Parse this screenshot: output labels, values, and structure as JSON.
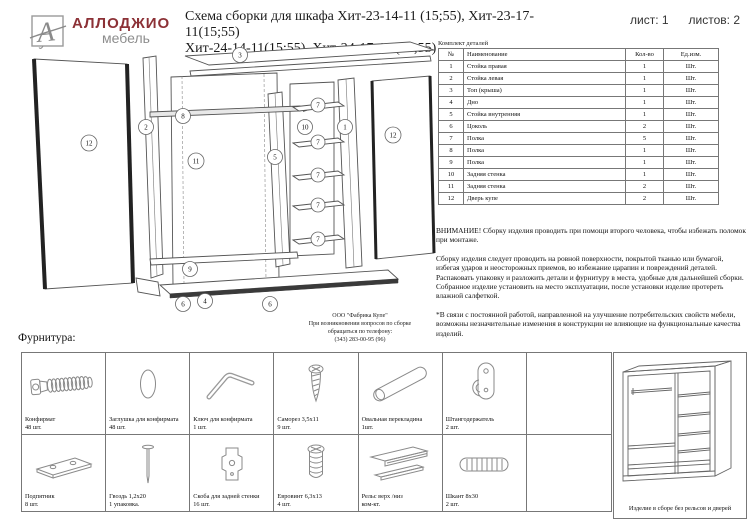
{
  "header": {
    "brand": "АЛЛОДЖИО",
    "brand_sub": "мебель",
    "title_line1": "Схема сборки для шкафа Хит-23-14-11 (15;55), Хит-23-17-11(15;55)",
    "title_line2": "Хит-24-14-11(15;55), Хит-24-17-11 (15;55)",
    "sheet": "лист: 1",
    "sheets_total": "листов: 2"
  },
  "parts_table": {
    "caption": "Комплект деталей",
    "columns": [
      "№",
      "Наименование",
      "Кол-во",
      "Ед.изм."
    ],
    "rows": [
      [
        "1",
        "Стойка правая",
        "1",
        "Шт."
      ],
      [
        "2",
        "Стойка левая",
        "1",
        "Шт."
      ],
      [
        "3",
        "Топ (крыша)",
        "1",
        "Шт."
      ],
      [
        "4",
        "Дно",
        "1",
        "Шт."
      ],
      [
        "5",
        "Стойка внутренняя",
        "1",
        "Шт."
      ],
      [
        "6",
        "Цоколь",
        "2",
        "Шт."
      ],
      [
        "7",
        "Полка",
        "5",
        "Шт."
      ],
      [
        "8",
        "Полка",
        "1",
        "Шт."
      ],
      [
        "9",
        "Полка",
        "1",
        "Шт."
      ],
      [
        "10",
        "Задняя стенка",
        "1",
        "Шт."
      ],
      [
        "11",
        "Задняя стенка",
        "2",
        "Шт."
      ],
      [
        "12",
        "Дверь купе",
        "2",
        "Шт."
      ]
    ]
  },
  "notes": {
    "warning": "ВНИМАНИЕ! Сборку изделия проводить при помощи второго человека, чтобы избежать поломок при монтаже.",
    "p1": "Сборку изделия следует проводить на ровной поверхности, покрытой тканью или бумагой, избегая ударов и неосторожных приемов, во избежание царапин и повреждений деталей.",
    "p2": "Распаковать упаковку и разложить детали и фурнитуру в места, удобные для дальнейшей сборки.",
    "p3": "Собранное изделие установить на место эксплуатации, после установки изделие протереть влажной салфеткой.",
    "p4": "*В связи с постоянной работой, направленной на улучшение потребительских свойств мебели, возможны незначительные изменения в конструкции не влияющие на функциональные качества изделий."
  },
  "diagram": {
    "callouts": [
      "3",
      "8",
      "2",
      "12",
      "11",
      "5",
      "10",
      "7",
      "7",
      "7",
      "7",
      "7",
      "1",
      "12",
      "9",
      "6",
      "4",
      "6"
    ],
    "factory_note": {
      "l1": "ООО \"Фабрика Купе\"",
      "l2": "При возникновении вопросов по сборке",
      "l3": "обращаться по телефону:",
      "l4": "(343) 283-00-95 (96)"
    }
  },
  "hardware": {
    "title": "Фурнитура:",
    "items": [
      {
        "icon": "confirmat-icon",
        "name": "Конфирмат",
        "qty": "48 шт."
      },
      {
        "icon": "cap-icon",
        "name": "Заглушка для конфирмата",
        "qty": "48 шт."
      },
      {
        "icon": "hex-key-icon",
        "name": "Ключ для конфирмата",
        "qty": "1 шт."
      },
      {
        "icon": "screw-icon",
        "name": "Саморез 3,5х11",
        "qty": "9 шт."
      },
      {
        "icon": "oval-bar-icon",
        "name": "Овальная перекладина",
        "qty": "1шт."
      },
      {
        "icon": "rod-holder-icon",
        "name": "Штангодержатель",
        "qty": "2 шт."
      },
      {
        "icon": "foot-pad-icon",
        "name": "Подпятник",
        "qty": "8 шт."
      },
      {
        "icon": "nail-icon",
        "name": "Гвоздь 1,2х20",
        "qty": "1 упаковка."
      },
      {
        "icon": "bracket-icon",
        "name": "Скоба для задней стенки",
        "qty": "16 шт."
      },
      {
        "icon": "euroscrew-icon",
        "name": "Евровинт 6,3х13",
        "qty": "4 шт."
      },
      {
        "icon": "rail-icon",
        "name": "Рельс верх /низ",
        "qty": "ком-кт."
      },
      {
        "icon": "dowel-icon",
        "name": "Шкант 8х30",
        "qty": "2 шт."
      }
    ]
  },
  "assembled": {
    "caption": "Изделие в сборе без рельсов и дверей"
  }
}
